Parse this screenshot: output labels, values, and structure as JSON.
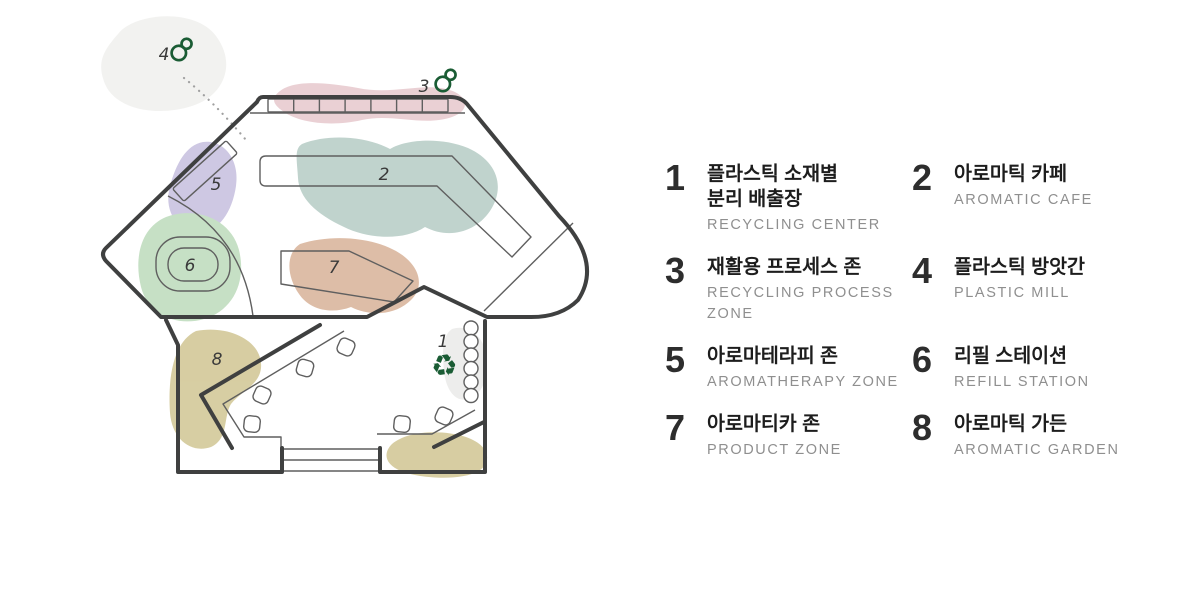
{
  "map": {
    "zone_labels": {
      "z1": "1",
      "z2": "2",
      "z3": "3",
      "z4": "4",
      "z5": "5",
      "z6": "6",
      "z7": "7",
      "z8": "8"
    },
    "icons": {
      "recycle_symbol": "♻"
    },
    "colors": {
      "wall": "#3f4040",
      "thin_line": "#5f5f5f",
      "accent_green": "#1a5c34",
      "blob_pink": "#e9cdd2",
      "blob_lavender": "#ccc6e2",
      "blob_teal": "#bdd1cb",
      "blob_green": "#c4dfc2",
      "blob_tan": "#dcbaa3",
      "blob_khaki": "#d5cb9e",
      "blob_gray": "#f1f1ef",
      "blob_gray_small": "#ededeb",
      "dotted_line": "#a0a0a0"
    }
  },
  "legend": {
    "items": [
      {
        "num": "1",
        "ko": "플라스틱 소재별\n분리 배출장",
        "en": "RECYCLING CENTER"
      },
      {
        "num": "2",
        "ko": "아로마틱 카페",
        "en": "AROMATIC CAFE"
      },
      {
        "num": "3",
        "ko": "재활용 프로세스 존",
        "en": "RECYCLING PROCESS\nZONE"
      },
      {
        "num": "4",
        "ko": "플라스틱 방앗간",
        "en": "PLASTIC MILL"
      },
      {
        "num": "5",
        "ko": "아로마테라피 존",
        "en": "AROMATHERAPY ZONE"
      },
      {
        "num": "6",
        "ko": "리필 스테이션",
        "en": "REFILL STATION"
      },
      {
        "num": "7",
        "ko": "아로마티카 존",
        "en": "PRODUCT ZONE"
      },
      {
        "num": "8",
        "ko": "아로마틱 가든",
        "en": "AROMATIC GARDEN"
      }
    ]
  }
}
